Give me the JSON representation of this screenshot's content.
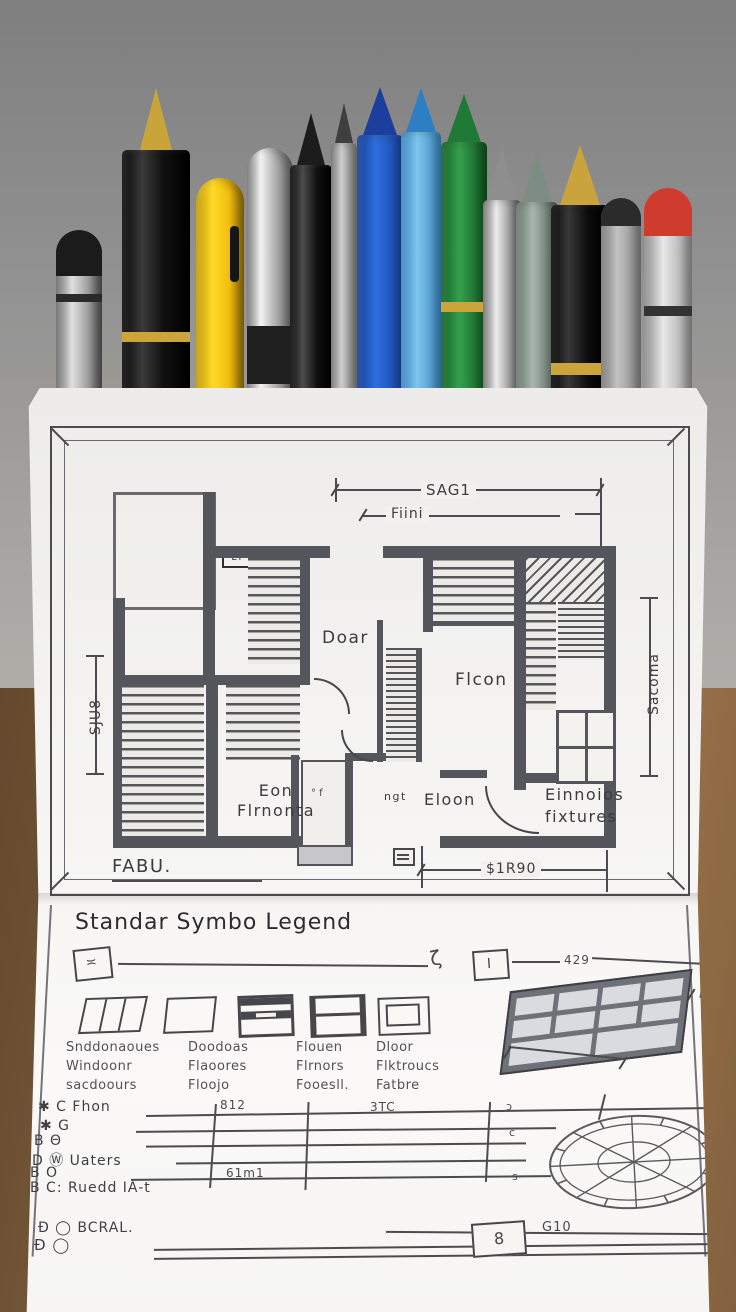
{
  "palette": {
    "backdrop_gray": "#8d8d8d",
    "desk_wood": "#83613f",
    "paper": "#f4f3f1",
    "plan_ink": "#47474b",
    "wall_gray": "#55565b"
  },
  "pens": [
    {
      "name": "pen-silver-pencil",
      "x": 56,
      "w": 46,
      "top": 230,
      "body": "linear-gradient(90deg,#6a6a6a,#e0e0e0 35%,#9e9e9e 70%,#595959)",
      "round": true,
      "cap": {
        "color": "#1b1b1b",
        "h": 46
      },
      "band": {
        "color": "#2a2a2a",
        "top": 64,
        "h": 8
      }
    },
    {
      "name": "pen-black-fountain",
      "x": 122,
      "w": 68,
      "top": 150,
      "body": "linear-gradient(90deg,#090909,#3a3a3a 30%,#111111 60%,#000000)",
      "tip": {
        "color": "#c9a43a",
        "h": 62,
        "w": 16
      },
      "band": {
        "color": "#caa53c",
        "top": 182,
        "h": 10
      }
    },
    {
      "name": "pen-yellow",
      "x": 196,
      "w": 48,
      "top": 178,
      "body": "linear-gradient(90deg,#bf9a0c,#ffd825 35%,#f1bd10 70%,#9e7a06)",
      "round": true,
      "band": {
        "color": "#161616",
        "top": 48,
        "h": 56,
        "side": "right"
      }
    },
    {
      "name": "pen-chrome",
      "x": 247,
      "w": 46,
      "top": 148,
      "body": "linear-gradient(90deg,#737373,#f4f4f4 30%,#bdbdbd 55%,#666666)",
      "round": true,
      "band": {
        "color": "#1f1f1f",
        "top": 178,
        "h": 58
      }
    },
    {
      "name": "pen-black-glossy",
      "x": 290,
      "w": 42,
      "top": 165,
      "body": "linear-gradient(90deg,#050505,#4d4d4d 30%,#101010 65%,#000000)",
      "tip": {
        "color": "#1c1c1c",
        "h": 52,
        "w": 14
      }
    },
    {
      "name": "pen-slim-gray",
      "x": 331,
      "w": 26,
      "top": 143,
      "body": "linear-gradient(90deg,#707070,#cfcfcf 40%,#858585)",
      "tip": {
        "color": "#3f3f3f",
        "h": 40,
        "w": 9
      }
    },
    {
      "name": "pen-blue",
      "x": 357,
      "w": 46,
      "top": 135,
      "body": "linear-gradient(90deg,#123f96,#2e6ede 40%,#1947a8)",
      "tip": {
        "color": "#1c3f9e",
        "h": 48,
        "w": 17
      }
    },
    {
      "name": "pen-cyan",
      "x": 401,
      "w": 40,
      "top": 132,
      "body": "linear-gradient(90deg,#3787c0,#7ec5ec 40%,#3d8ec9)",
      "tip": {
        "color": "#2d7ec2",
        "h": 44,
        "w": 15
      }
    },
    {
      "name": "pen-green",
      "x": 441,
      "w": 46,
      "top": 142,
      "body": "linear-gradient(90deg,#156127,#35a04f 40%,#12551f)",
      "tip": {
        "color": "#1f7a35",
        "h": 48,
        "w": 17
      },
      "band": {
        "color": "#caa53c",
        "top": 160,
        "h": 10
      }
    },
    {
      "name": "pen-chrome-bullet",
      "x": 483,
      "w": 38,
      "top": 200,
      "body": "linear-gradient(90deg,#6f6f6f,#ededed 35%,#9e9e9e 70%,#5c5c5c)",
      "tip": {
        "color": "#8e8e8e",
        "h": 52,
        "w": 14
      }
    },
    {
      "name": "pen-sage",
      "x": 516,
      "w": 42,
      "top": 202,
      "body": "linear-gradient(90deg,#66756c,#a9b6ad 40%,#4f5e55)",
      "tip": {
        "color": "#7e8d84",
        "h": 50,
        "w": 15
      }
    },
    {
      "name": "pen-black-gold",
      "x": 551,
      "w": 58,
      "top": 205,
      "body": "linear-gradient(90deg,#060606,#383838 30%,#0b0b0b 65%,#000000)",
      "tip": {
        "color": "#c9a43c",
        "h": 60,
        "w": 20
      },
      "band": {
        "color": "#caa53c",
        "top": 158,
        "h": 12
      }
    },
    {
      "name": "pen-gray",
      "x": 601,
      "w": 40,
      "top": 198,
      "body": "linear-gradient(90deg,#787878,#c2c2c2 40%,#8a8a8a)",
      "round": true,
      "cap": {
        "color": "#2b2b2b",
        "h": 28
      }
    },
    {
      "name": "pen-red-tip",
      "x": 644,
      "w": 48,
      "top": 188,
      "body": "linear-gradient(90deg,#8a8a8a,#e8e8e8 40%,#9b9b9b)",
      "round": true,
      "cap": {
        "color": "#cf3b2e",
        "h": 48
      },
      "band": {
        "color": "#333333",
        "top": 118,
        "h": 10
      }
    }
  ],
  "plan": {
    "dim_top_outer": "SAG1",
    "dim_top_inner": "Fiini",
    "dim_left": "SJU8-",
    "dim_right": "Sacoma",
    "dim_bottom": "$1R90",
    "wall_tag": "ET",
    "room_doar": "Doar",
    "room_flcon": "Flcon",
    "room_eon_1": "Eon",
    "room_eon_2": "Flrnonta",
    "label_ngt": "ngt",
    "room_eloon": "Eloon",
    "fixtures_1": "Einnoios",
    "fixtures_2": "fixtures",
    "door_marks": "° f",
    "title_block": "FABU."
  },
  "legend": {
    "title": "Standar Symbo Legend",
    "ruler_box_left": "≍",
    "ruler_squiggle": "ζ",
    "ruler_box_mid": "I",
    "ruler_dim": "429",
    "columns": [
      {
        "lines": [
          "Snddonaoues",
          "Windoonr",
          "sacdoours"
        ]
      },
      {
        "lines": [
          "Doodoas",
          "Flaoores",
          "Floojo"
        ]
      },
      {
        "lines": [
          "Flouen",
          "Flrnors",
          "Fooesll."
        ]
      },
      {
        "lines": [
          "Dloor",
          "Flktroucs",
          "Fatbre"
        ]
      }
    ],
    "rows": [
      {
        "label": "✱ C Fhon",
        "dim": "812",
        "dim2": "3TC"
      },
      {
        "label": "✱ G"
      },
      {
        "label": "B Θ"
      },
      {
        "label": "D Ⓦ Uaters"
      },
      {
        "label": "B O",
        "dim": "61m1"
      },
      {
        "label": "B C: Ruedd IA-t"
      }
    ],
    "edge_marks": [
      "ɔ",
      "c",
      "s"
    ],
    "footer_line1": "Ð ◯ BCRAL.",
    "footer_line2": "Ð ◯",
    "footer_box": "8",
    "footer_dim": "G10"
  }
}
